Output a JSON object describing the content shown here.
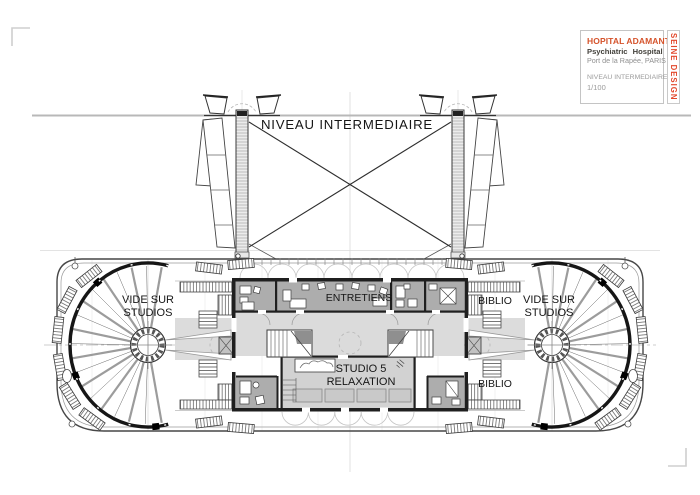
{
  "page": {
    "heading": "NIVEAU INTERMEDIAIRE"
  },
  "title_block": {
    "project": "HOPITAL ADAMANT",
    "subtitle": "Psychiatric Hospital",
    "address": "Port de la Rapée, PARIS",
    "drawing_title": "NIVEAU INTERMEDIAIRE",
    "scale": "1/100",
    "firm": "SEINE DESIGN"
  },
  "rooms": {
    "void_line1": "VIDE SUR",
    "void_line2": "STUDIOS",
    "entretiens": "ENTRETIENS",
    "studio_line1": "STUDIO 5",
    "studio_line2": "RELAXATION",
    "biblio_top": "BIBLIO",
    "biblio_bottom": "BIBLIO"
  },
  "colors": {
    "firm_red": "#e2472b",
    "project_orange": "#d5532b",
    "muted_gray": "#8f8f8f",
    "room_dark": "#adadad",
    "room_light": "#dbdbdb",
    "ink": "#1a1a1a"
  }
}
